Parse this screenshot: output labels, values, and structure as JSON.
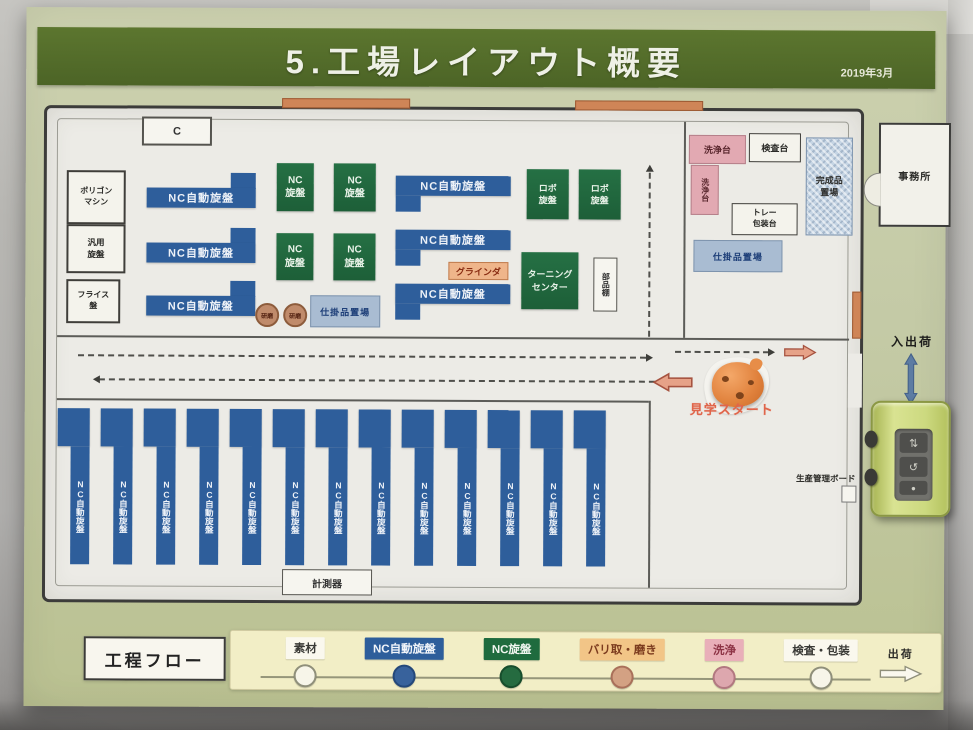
{
  "palette": {
    "poster_green": "#c4caa6",
    "title_bar_green": "#52692b",
    "nc_auto_blue": "#2e5e9b",
    "nc_lathe_green": "#1d5f38",
    "grinder_salmon": "#efb58a",
    "washing_pink": "#e2a9b2",
    "storage_blue": "#a9bcd2",
    "legend_cream": "#f2eec6",
    "route_arrow_salmon": "#e6a288",
    "in_out_arrow_blue": "#5d7ca3"
  },
  "title_bar": {
    "title": "5.工場レイアウト概要",
    "date": "2019年3月"
  },
  "floor_plan": {
    "c_label": "C",
    "machines": {
      "polygon": "ポリゴン\nマシン",
      "general_lathe": "汎用\n旋盤",
      "milling": "フライス\n盤",
      "nc_auto_lathe": "NC自動旋盤",
      "nc_lathe": "NC\n旋盤",
      "robo_lathe": "ロボ\n旋盤",
      "grinder": "グラインダ",
      "turning_center": "ターニング\nセンター",
      "parts_shelf": "部品棚",
      "polish_station": "研磨",
      "bottom_nc_auto": {
        "label": "NC自動旋盤",
        "count": 13
      }
    },
    "stations": {
      "washing_stand": "洗浄台",
      "washing_stand_vertical": "洗浄台",
      "inspection_stand": "検査台",
      "tray_packing_stand": "トレー\n包装台",
      "finished_goods_storage": "完成品\n置場",
      "wip_storage_upper": "仕掛品置場",
      "wip_storage_right": "仕掛品置場",
      "measuring_instruments": "計測器",
      "production_board": "生産管理ボード"
    },
    "annotations": {
      "office": "事務所",
      "in_out_shipping": "入出荷",
      "tour_start": "見学スタート"
    }
  },
  "process_flow": {
    "title": "工程フロー",
    "end_label": "出荷",
    "steps": [
      {
        "label": "素材",
        "bg": "#faf8ee",
        "fg": "#3a3a36",
        "circle": "#f7f5e9",
        "circle_border": "#8f8f7a"
      },
      {
        "label": "NC自動旋盤",
        "bg": "#2e5e9b",
        "fg": "#f2f5fa",
        "circle": "#38629c",
        "circle_border": "#24487a"
      },
      {
        "label": "NC旋盤",
        "bg": "#1f6b3e",
        "fg": "#f0f6f0",
        "circle": "#256b40",
        "circle_border": "#174d2c"
      },
      {
        "label": "バリ取・磨き",
        "bg": "#f2c587",
        "fg": "#7c3b1e",
        "circle": "#d3a183",
        "circle_border": "#a9705a"
      },
      {
        "label": "洗浄",
        "bg": "#e9afb9",
        "fg": "#8d3345",
        "circle": "#dda7ae",
        "circle_border": "#b27880"
      },
      {
        "label": "検査・包装",
        "bg": "#faf8ee",
        "fg": "#3a3a36",
        "circle": "#f7f5e9",
        "circle_border": "#8f8f7a"
      }
    ]
  }
}
